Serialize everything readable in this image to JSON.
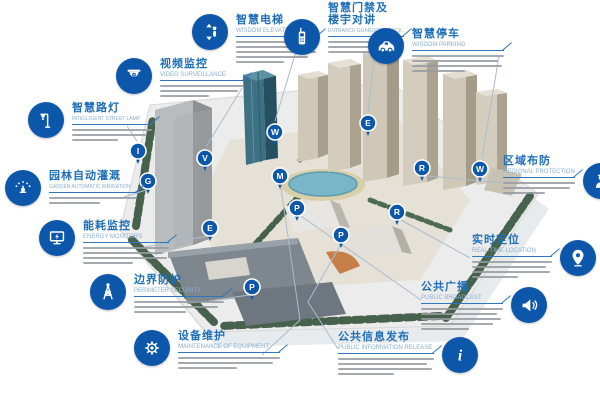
{
  "palette": {
    "accent": "#0d57aa",
    "title_blue": "#1f6fb8",
    "subtitle_blue": "#8ab0d4",
    "rule_blue": "#2e77c0",
    "leader": "#aabccd",
    "desc_gray": "#969ba1"
  },
  "callouts": [
    {
      "id": "wisdom-elevator",
      "title": "智慧电梯",
      "subtitle": "WISDOM ELEVATOR",
      "icon": "elevator-icon",
      "desc_lines": 5
    },
    {
      "id": "entrance-guard",
      "title": "智慧门禁及楼宇对讲",
      "subtitle": "ENTRANCE GUARD/TALKBACK",
      "icon": "intercom-icon",
      "desc_lines": 3
    },
    {
      "id": "wisdom-parking",
      "title": "智慧停车",
      "subtitle": "WISDOM PARKING",
      "icon": "car-icon",
      "desc_lines": 4
    },
    {
      "id": "video-surveillance",
      "title": "视频监控",
      "subtitle": "VIDEO SURVEILLANCE",
      "icon": "dome-camera-icon",
      "desc_lines": 3
    },
    {
      "id": "intelligent-street-lamp",
      "title": "智慧路灯",
      "subtitle": "INTELLIGENT STREET LAMP",
      "icon": "street-lamp-icon",
      "desc_lines": 3
    },
    {
      "id": "garden-irrigation",
      "title": "园林自动灌溉",
      "subtitle": "GARDEN AUTOMATIC IRRIGATION",
      "icon": "sprinkler-icon",
      "desc_lines": 2
    },
    {
      "id": "energy-monitors",
      "title": "能耗监控",
      "subtitle": "ENERGY MONITORS",
      "icon": "monitor-icon",
      "desc_lines": 4
    },
    {
      "id": "perimeter-security",
      "title": "边界防护",
      "subtitle": "PERIMETER SECURITY",
      "icon": "watchtower-icon",
      "desc_lines": 3
    },
    {
      "id": "maintenance",
      "title": "设备维护",
      "subtitle": "MAINTENANCE OF EQUIPMENT",
      "icon": "gear-wrench-icon",
      "desc_lines": 3
    },
    {
      "id": "regional-protection",
      "title": "区域布防",
      "subtitle": "REGIONAL PROTECTION",
      "icon": "guard-icon",
      "desc_lines": 3
    },
    {
      "id": "real-time-location",
      "title": "实时定位",
      "subtitle": "REAL-TIME LOCATION",
      "icon": "location-pin-icon",
      "desc_lines": 4
    },
    {
      "id": "public-broadcast",
      "title": "公共广播",
      "subtitle": "PUBLIC BROADCAST",
      "icon": "megaphone-icon",
      "desc_lines": 5
    },
    {
      "id": "public-info-release",
      "title": "公共信息发布",
      "subtitle": "PUBLIC INFORMATION RELEASE",
      "icon": "info-icon",
      "desc_lines": 4
    }
  ],
  "map": {
    "markers": [
      {
        "letter": "W",
        "x": 275,
        "y": 132
      },
      {
        "letter": "E",
        "x": 368,
        "y": 123
      },
      {
        "letter": "W",
        "x": 480,
        "y": 169
      },
      {
        "letter": "V",
        "x": 205,
        "y": 158
      },
      {
        "letter": "I",
        "x": 138,
        "y": 151
      },
      {
        "letter": "G",
        "x": 148,
        "y": 181
      },
      {
        "letter": "E",
        "x": 210,
        "y": 228
      },
      {
        "letter": "P",
        "x": 252,
        "y": 287
      },
      {
        "letter": "M",
        "x": 280,
        "y": 176
      },
      {
        "letter": "R",
        "x": 422,
        "y": 168
      },
      {
        "letter": "R",
        "x": 397,
        "y": 212
      },
      {
        "letter": "P",
        "x": 297,
        "y": 208
      },
      {
        "letter": "P",
        "x": 341,
        "y": 235
      }
    ],
    "leader_lines": [
      [
        [
          300,
          38
        ],
        [
          275,
          121
        ]
      ],
      [
        [
          376,
          44
        ],
        [
          368,
          112
        ]
      ],
      [
        [
          499,
          56
        ],
        [
          482,
          158
        ]
      ],
      [
        [
          242,
          88
        ],
        [
          206,
          147
        ]
      ],
      [
        [
          127,
          126
        ],
        [
          137,
          141
        ]
      ],
      [
        [
          124,
          197
        ],
        [
          146,
          190
        ]
      ],
      [
        [
          144,
          247
        ],
        [
          208,
          236
        ]
      ],
      [
        [
          209,
          301
        ],
        [
          249,
          295
        ]
      ],
      [
        [
          262,
          355
        ],
        [
          300,
          320
        ],
        [
          281,
          188
        ]
      ],
      [
        [
          503,
          183
        ],
        [
          427,
          176
        ]
      ],
      [
        [
          470,
          258
        ],
        [
          401,
          220
        ]
      ],
      [
        [
          421,
          300
        ],
        [
          301,
          216
        ]
      ],
      [
        [
          338,
          349
        ],
        [
          308,
          302
        ],
        [
          341,
          244
        ]
      ]
    ]
  }
}
